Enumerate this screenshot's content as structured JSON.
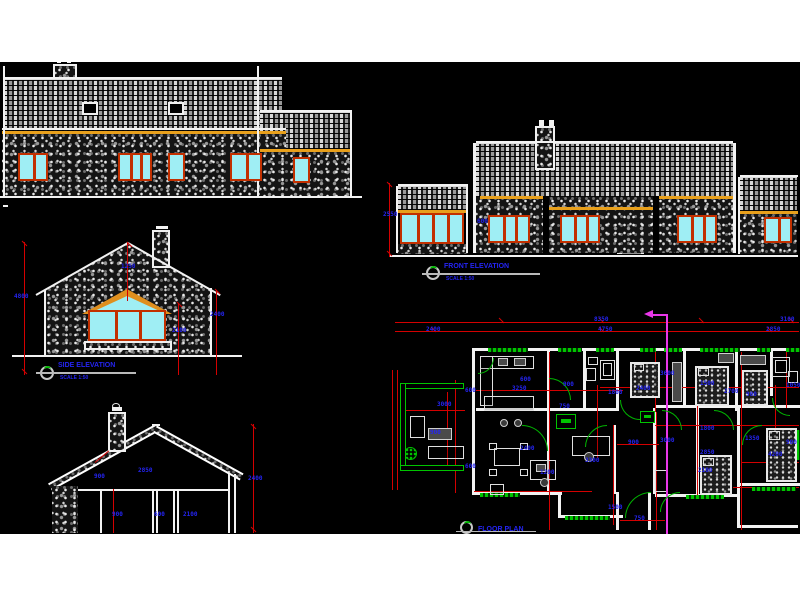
{
  "titles": {
    "side": {
      "label": "SIDE ELEVATION",
      "scale": "SCALE 1:50"
    },
    "front": {
      "label": "FRONT ELEVATION",
      "scale": "SCALE 1:50"
    },
    "plan": {
      "label": "FLOOR PLAN"
    }
  },
  "colors": {
    "canvas": "#000000",
    "page": "#ffffff",
    "dimension_text": "#2424f2",
    "dimension_line": "#d40000",
    "fascia": "#e8a01c",
    "window_frame": "#c23000",
    "glazing": "#9feef4",
    "green": "#00c400",
    "section_line": "#e937e9",
    "line": "#f2f2f2"
  },
  "geometry": {
    "tiles": [
      [
        4,
        79,
        278,
        52
      ],
      [
        260,
        112,
        90,
        37
      ],
      [
        398,
        186,
        70,
        24
      ],
      [
        476,
        143,
        257,
        54
      ],
      [
        740,
        177,
        57,
        34
      ]
    ],
    "stone": [
      [
        2,
        134,
        284,
        63
      ],
      [
        260,
        152,
        90,
        44
      ],
      [
        476,
        197,
        257,
        56
      ],
      [
        740,
        214,
        57,
        40
      ],
      [
        397,
        244,
        71,
        10
      ],
      [
        52,
        486,
        26,
        47
      ]
    ],
    "chim": [
      [
        53,
        64,
        24,
        15
      ],
      [
        152,
        230,
        18,
        38
      ],
      [
        108,
        412,
        18,
        40
      ],
      [
        535,
        126,
        20,
        44
      ],
      [
        84,
        341,
        88,
        9
      ]
    ],
    "yellow": [
      [
        2,
        131,
        284,
        3
      ],
      [
        260,
        149,
        92,
        3
      ],
      [
        398,
        210,
        70,
        3
      ],
      [
        480,
        196,
        64,
        3
      ],
      [
        548,
        207,
        106,
        3
      ],
      [
        658,
        196,
        75,
        3
      ],
      [
        740,
        211,
        58,
        3
      ]
    ],
    "black": [
      [
        543,
        196,
        6,
        58
      ],
      [
        653,
        196,
        6,
        58
      ]
    ],
    "rooflights": [
      [
        82,
        102,
        16,
        13
      ],
      [
        168,
        102,
        16,
        13
      ]
    ],
    "windows": [
      [
        18,
        153,
        30,
        28,
        1
      ],
      [
        118,
        153,
        34,
        28,
        2
      ],
      [
        168,
        153,
        17,
        28,
        0
      ],
      [
        230,
        153,
        32,
        28,
        1
      ],
      [
        293,
        157,
        17,
        26,
        0
      ],
      [
        88,
        310,
        78,
        31,
        2
      ],
      [
        400,
        213,
        64,
        31,
        3
      ],
      [
        488,
        215,
        42,
        28,
        2
      ],
      [
        560,
        215,
        40,
        28,
        2
      ],
      [
        677,
        215,
        40,
        28,
        2
      ],
      [
        764,
        217,
        28,
        26,
        1
      ]
    ],
    "white": [
      [
        4,
        77,
        278,
        2
      ],
      [
        3,
        66,
        2,
        130
      ],
      [
        257,
        66,
        2,
        130
      ],
      [
        350,
        110,
        2,
        86
      ],
      [
        260,
        110,
        92,
        2
      ],
      [
        2,
        128,
        284,
        2
      ],
      [
        0,
        196,
        362,
        2
      ],
      [
        3,
        205,
        5,
        2
      ],
      [
        57,
        60,
        4,
        3
      ],
      [
        67,
        60,
        4,
        3
      ],
      [
        156,
        226,
        12,
        3
      ],
      [
        539,
        120,
        5,
        6
      ],
      [
        549,
        120,
        5,
        6
      ],
      [
        112,
        407,
        10,
        4
      ],
      [
        12,
        355,
        230,
        2
      ],
      [
        36,
        294,
        106,
        2,
        "rm30"
      ],
      [
        128,
        242,
        106,
        2,
        "r30"
      ],
      [
        44,
        290,
        2,
        66
      ],
      [
        210,
        288,
        2,
        68
      ],
      [
        78,
        489,
        152,
        2
      ],
      [
        100,
        491,
        2,
        42
      ],
      [
        152,
        491,
        2,
        42
      ],
      [
        156,
        491,
        2,
        42
      ],
      [
        173,
        491,
        2,
        42
      ],
      [
        177,
        491,
        2,
        42
      ],
      [
        228,
        474,
        2,
        59
      ],
      [
        234,
        474,
        2,
        59
      ],
      [
        152,
        424,
        8,
        2
      ],
      [
        473,
        143,
        3,
        110
      ],
      [
        733,
        143,
        3,
        110
      ],
      [
        738,
        177,
        2,
        77
      ],
      [
        396,
        186,
        2,
        67
      ],
      [
        466,
        186,
        2,
        67
      ],
      [
        390,
        255,
        408,
        2
      ],
      [
        476,
        141,
        257,
        2
      ],
      [
        398,
        184,
        70,
        2
      ],
      [
        740,
        175,
        58,
        2
      ],
      [
        472,
        348,
        326,
        3
      ],
      [
        472,
        348,
        3,
        146
      ],
      [
        547,
        351,
        3,
        60
      ],
      [
        583,
        351,
        3,
        57
      ],
      [
        616,
        351,
        3,
        60
      ],
      [
        683,
        351,
        3,
        57
      ],
      [
        735,
        351,
        3,
        60
      ],
      [
        770,
        351,
        3,
        45
      ],
      [
        476,
        408,
        74,
        3
      ],
      [
        550,
        408,
        66,
        3
      ],
      [
        655,
        405,
        145,
        3
      ],
      [
        547,
        408,
        3,
        86
      ],
      [
        613,
        425,
        3,
        69
      ],
      [
        653,
        408,
        3,
        86
      ],
      [
        696,
        408,
        3,
        88
      ],
      [
        737,
        408,
        3,
        120
      ],
      [
        472,
        492,
        90,
        3
      ],
      [
        558,
        492,
        3,
        26
      ],
      [
        558,
        515,
        65,
        3
      ],
      [
        616,
        492,
        3,
        38
      ],
      [
        648,
        492,
        3,
        38
      ],
      [
        655,
        494,
        85,
        3
      ],
      [
        740,
        483,
        60,
        3
      ],
      [
        740,
        525,
        58,
        3
      ]
    ],
    "red": [
      [
        24,
        242,
        1,
        133
      ],
      [
        127,
        243,
        1,
        58
      ],
      [
        178,
        303,
        1,
        72
      ],
      [
        216,
        290,
        1,
        85
      ],
      [
        113,
        489,
        1,
        44
      ],
      [
        253,
        424,
        1,
        109
      ],
      [
        95,
        462,
        18,
        1,
        "rm40"
      ],
      [
        389,
        183,
        1,
        74
      ],
      [
        395,
        322,
        404,
        1
      ],
      [
        395,
        331,
        404,
        1
      ],
      [
        392,
        370,
        1,
        120
      ],
      [
        397,
        370,
        1,
        120
      ],
      [
        405,
        410,
        60,
        1
      ],
      [
        447,
        392,
        1,
        76
      ],
      [
        455,
        380,
        1,
        113
      ],
      [
        549,
        352,
        1,
        178
      ],
      [
        597,
        385,
        1,
        73
      ],
      [
        613,
        425,
        1,
        100
      ],
      [
        655,
        352,
        1,
        60
      ],
      [
        656,
        412,
        1,
        118
      ],
      [
        697,
        385,
        1,
        112
      ],
      [
        741,
        352,
        1,
        178
      ],
      [
        775,
        385,
        1,
        45
      ],
      [
        786,
        352,
        1,
        56
      ],
      [
        476,
        390,
        147,
        1
      ],
      [
        600,
        387,
        199,
        1
      ],
      [
        474,
        491,
        118,
        1
      ],
      [
        655,
        425,
        144,
        1
      ],
      [
        617,
        444,
        42,
        1
      ],
      [
        733,
        487,
        66,
        1
      ],
      [
        741,
        462,
        58,
        1
      ],
      [
        620,
        520,
        45,
        1
      ]
    ],
    "red_ticks": [
      [
        498,
        320
      ],
      [
        598,
        320
      ],
      [
        698,
        320
      ],
      [
        788,
        320
      ],
      [
        430,
        329
      ],
      [
        598,
        329
      ],
      [
        766,
        329
      ],
      [
        21,
        243
      ],
      [
        21,
        371
      ],
      [
        250,
        426
      ],
      [
        250,
        529
      ],
      [
        386,
        184
      ],
      [
        386,
        253
      ],
      [
        126,
        244
      ],
      [
        176,
        304
      ],
      [
        214,
        291
      ]
    ],
    "green_bars": [
      [
        488,
        348,
        40,
        4
      ],
      [
        558,
        348,
        24,
        4
      ],
      [
        596,
        348,
        18,
        4
      ],
      [
        640,
        348,
        16,
        4
      ],
      [
        664,
        348,
        18,
        4
      ],
      [
        700,
        348,
        40,
        4
      ],
      [
        757,
        348,
        14,
        4
      ],
      [
        786,
        348,
        14,
        4
      ],
      [
        480,
        493,
        40,
        4
      ],
      [
        565,
        516,
        45,
        4
      ],
      [
        686,
        495,
        38,
        4
      ],
      [
        752,
        487,
        44,
        4
      ],
      [
        796,
        430,
        4,
        30
      ]
    ],
    "green_walls": [
      [
        400,
        383,
        64,
        6
      ],
      [
        400,
        383,
        6,
        88
      ],
      [
        400,
        465,
        64,
        6
      ]
    ],
    "arcs": [
      [
        549,
        378,
        22,
        22,
        "tr"
      ],
      [
        585,
        425,
        22,
        22,
        "tl"
      ],
      [
        620,
        400,
        20,
        20,
        "bl"
      ],
      [
        662,
        410,
        20,
        20,
        "tr"
      ],
      [
        714,
        410,
        20,
        20,
        "tr"
      ],
      [
        742,
        425,
        20,
        20,
        "tl"
      ],
      [
        772,
        398,
        18,
        18,
        "bl"
      ],
      [
        625,
        492,
        26,
        26,
        "tl"
      ],
      [
        522,
        425,
        26,
        26,
        "tr"
      ],
      [
        660,
        492,
        20,
        20,
        "tl"
      ],
      [
        478,
        358,
        16,
        16,
        "br"
      ]
    ],
    "vents": [
      [
        556,
        414,
        20,
        15
      ],
      [
        640,
        411,
        15,
        12
      ]
    ],
    "beds": [
      [
        630,
        362,
        30,
        36
      ],
      [
        695,
        366,
        34,
        40
      ],
      [
        700,
        455,
        32,
        40
      ],
      [
        766,
        428,
        31,
        54
      ],
      [
        742,
        370,
        26,
        36
      ]
    ],
    "furn_w": [
      [
        480,
        356,
        54,
        13
      ],
      [
        480,
        356,
        13,
        50
      ],
      [
        484,
        396,
        50,
        15
      ],
      [
        494,
        448,
        26,
        18
      ],
      [
        489,
        443,
        8,
        7
      ],
      [
        520,
        443,
        8,
        7
      ],
      [
        489,
        469,
        8,
        7
      ],
      [
        520,
        469,
        8,
        7
      ],
      [
        530,
        460,
        26,
        20
      ],
      [
        572,
        436,
        38,
        20
      ],
      [
        428,
        446,
        36,
        13
      ],
      [
        410,
        416,
        15,
        22
      ],
      [
        490,
        484,
        14,
        11
      ],
      [
        600,
        360,
        15,
        20
      ],
      [
        603,
        363,
        9,
        13
      ],
      [
        586,
        368,
        10,
        13
      ],
      [
        588,
        357,
        10,
        8
      ],
      [
        772,
        357,
        18,
        20
      ],
      [
        775,
        360,
        12,
        13
      ],
      [
        788,
        371,
        10,
        12
      ],
      [
        634,
        364,
        10,
        7
      ],
      [
        698,
        368,
        11,
        8
      ],
      [
        703,
        458,
        11,
        8
      ],
      [
        769,
        431,
        11,
        9
      ],
      [
        655,
        470,
        12,
        22
      ]
    ],
    "furn_g": [
      [
        498,
        358,
        10,
        8
      ],
      [
        514,
        358,
        12,
        8
      ],
      [
        428,
        428,
        24,
        12
      ],
      [
        536,
        464,
        10,
        8
      ],
      [
        672,
        362,
        10,
        40
      ],
      [
        740,
        355,
        26,
        10
      ],
      [
        718,
        353,
        16,
        10
      ]
    ],
    "rounds": [
      [
        500,
        419,
        8,
        8
      ],
      [
        514,
        419,
        8,
        8
      ],
      [
        584,
        452,
        10,
        10
      ],
      [
        540,
        478,
        9,
        9
      ]
    ],
    "magenta": [
      [
        666,
        314,
        2,
        220
      ],
      [
        652,
        314,
        14,
        2
      ]
    ]
  },
  "dim_labels": [
    [
      14,
      294,
      "4800"
    ],
    [
      121,
      264,
      "1250"
    ],
    [
      172,
      328,
      "2100"
    ],
    [
      210,
      312,
      "2400"
    ],
    [
      138,
      468,
      "2850"
    ],
    [
      112,
      512,
      "900"
    ],
    [
      154,
      512,
      "600"
    ],
    [
      183,
      512,
      "2100"
    ],
    [
      248,
      476,
      "2400"
    ],
    [
      94,
      474,
      "900"
    ],
    [
      383,
      212,
      "2550"
    ],
    [
      477,
      219,
      "600"
    ],
    [
      594,
      317,
      "8350"
    ],
    [
      780,
      317,
      "3100"
    ],
    [
      426,
      327,
      "2400"
    ],
    [
      598,
      327,
      "4750"
    ],
    [
      766,
      327,
      "2850"
    ],
    [
      465,
      388,
      "600"
    ],
    [
      465,
      464,
      "600"
    ],
    [
      437,
      402,
      "3000"
    ],
    [
      430,
      430,
      "900"
    ],
    [
      512,
      386,
      "3250"
    ],
    [
      563,
      382,
      "900"
    ],
    [
      608,
      390,
      "1800"
    ],
    [
      559,
      404,
      "750"
    ],
    [
      520,
      377,
      "600"
    ],
    [
      636,
      386,
      "2400"
    ],
    [
      660,
      371,
      "3600"
    ],
    [
      700,
      381,
      "1500"
    ],
    [
      724,
      389,
      "2700"
    ],
    [
      786,
      383,
      "1050"
    ],
    [
      746,
      392,
      "900"
    ],
    [
      520,
      446,
      "2400"
    ],
    [
      585,
      458,
      "3300"
    ],
    [
      628,
      440,
      "900"
    ],
    [
      660,
      438,
      "3000"
    ],
    [
      700,
      450,
      "2850"
    ],
    [
      745,
      436,
      "1350"
    ],
    [
      768,
      452,
      "4200"
    ],
    [
      540,
      470,
      "1200"
    ],
    [
      608,
      505,
      "1500"
    ],
    [
      698,
      468,
      "2100"
    ],
    [
      786,
      440,
      "900"
    ],
    [
      634,
      516,
      "750"
    ],
    [
      700,
      426,
      "1800"
    ]
  ]
}
